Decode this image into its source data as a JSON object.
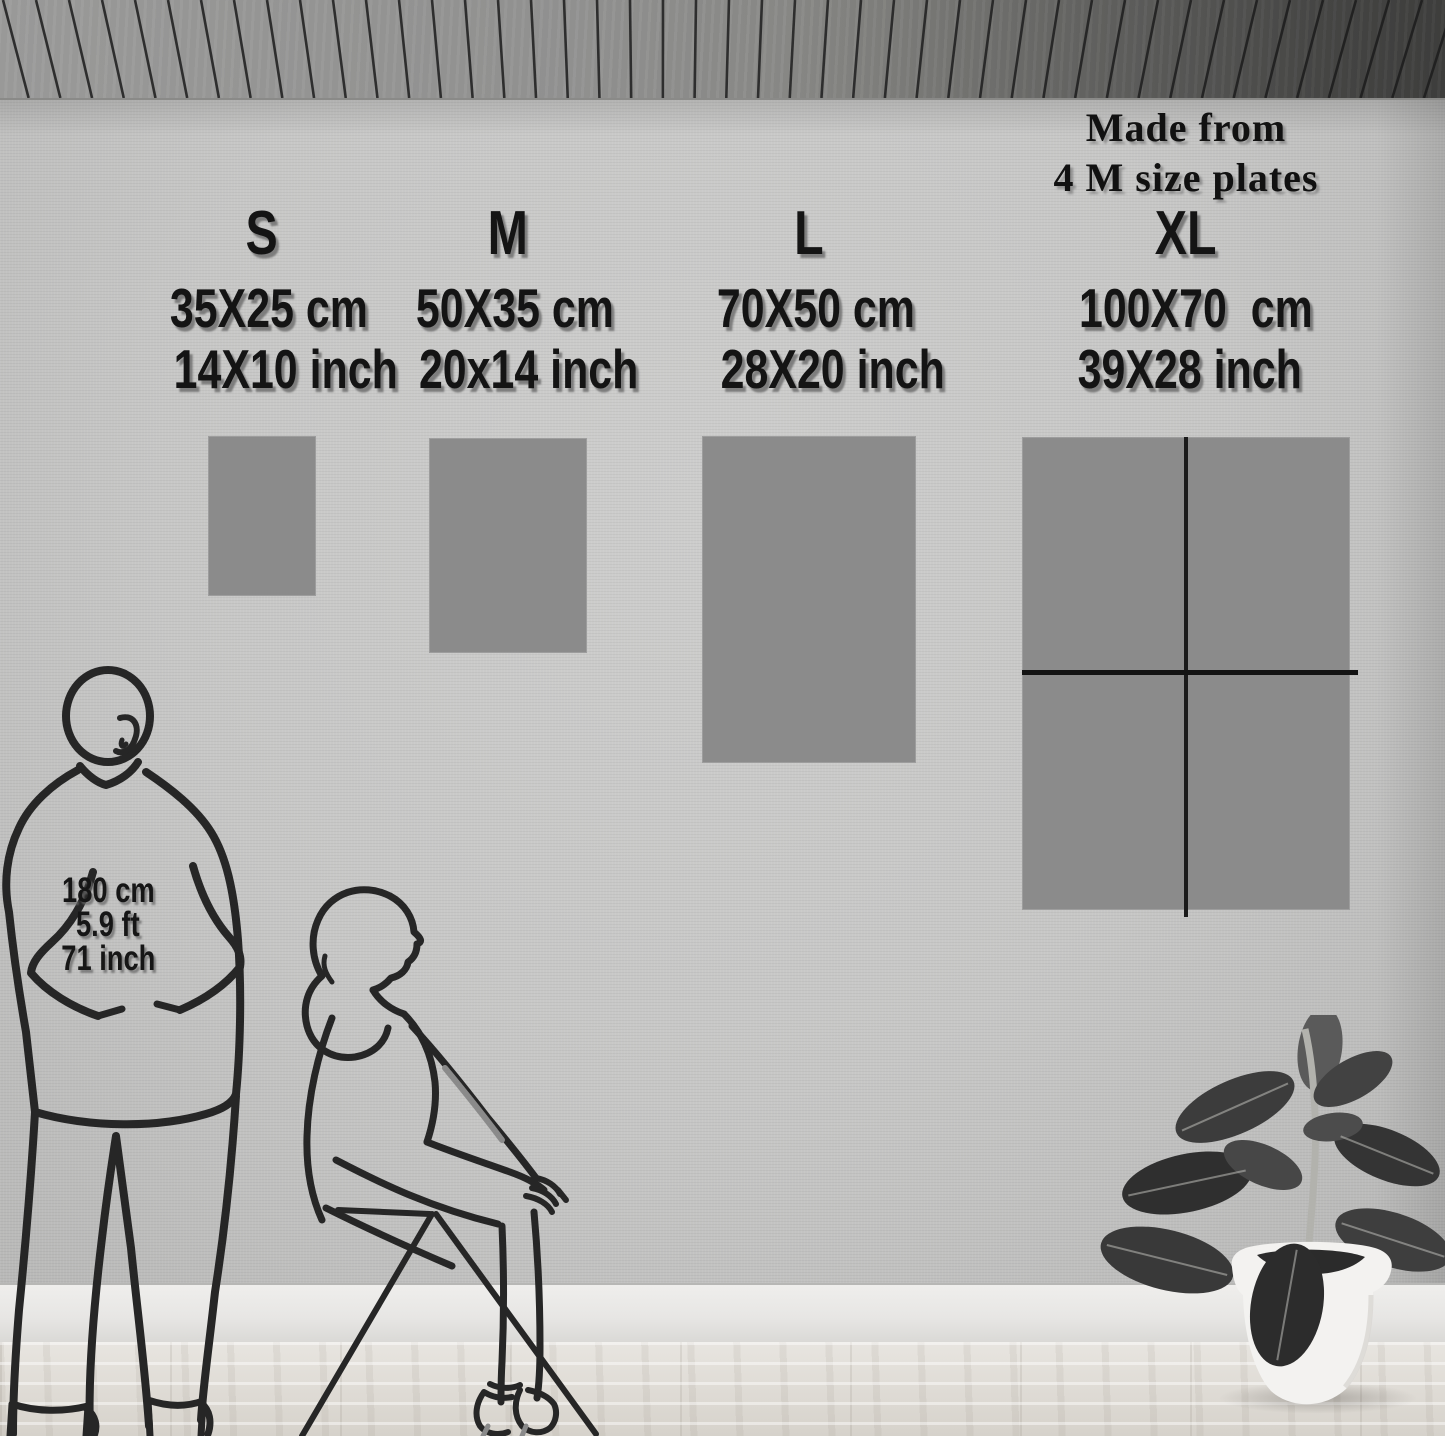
{
  "note": {
    "line1": "Made from",
    "line2": "4 M size plates"
  },
  "sizes": [
    {
      "label": "S",
      "cm": "35X25 cm",
      "inch": "14X10 inch"
    },
    {
      "label": "M",
      "cm": "50X35 cm",
      "inch": "20x14 inch"
    },
    {
      "label": "L",
      "cm": "70X50 cm",
      "inch": "28X20 inch"
    },
    {
      "label": "XL",
      "cm": "100X70  cm",
      "inch": "39X28 inch"
    }
  ],
  "reference_height": {
    "cm": "180 cm",
    "ft": "5.9 ft",
    "inch": "71 inch"
  },
  "figures": {
    "man": "standing-man-outline",
    "woman": "seated-woman-on-stool-outline",
    "plant": "rubber-plant-in-white-pot"
  },
  "colors": {
    "plate": "#8b8b8b",
    "text": "#141414",
    "line_art": "#262626",
    "pot": "#f3f2f0",
    "leaf": "#353535"
  }
}
